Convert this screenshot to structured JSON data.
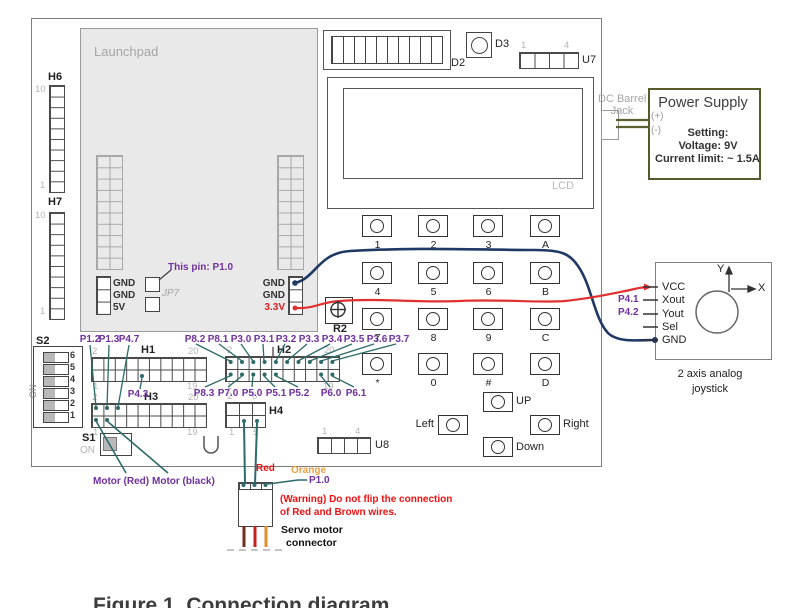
{
  "launchpad": {
    "label": "Launchpad",
    "this_pin": "This pin: P1.0",
    "jp7": "JP7",
    "left_pins": [
      "GND",
      "GND",
      "5V"
    ],
    "right_pins": [
      "GND",
      "GND",
      "3.3V"
    ]
  },
  "headers": {
    "h6": {
      "label": "H6",
      "top": "10",
      "bottom": "1"
    },
    "h7": {
      "label": "H7",
      "top": "10",
      "bottom": "1"
    },
    "h1": {
      "label": "H1",
      "tl": "2",
      "tr": "20",
      "bl": "1",
      "br": "19"
    },
    "h2": {
      "label": "H2",
      "tl": "2",
      "tr": "20",
      "bl": "1",
      "br": "19"
    },
    "h3": {
      "label": "H3",
      "tl": "2",
      "tr": "20",
      "bl": "1",
      "br": "19"
    },
    "h4": {
      "label": "H4",
      "tl": "2",
      "tr": "6",
      "bl": "1",
      "br": "5"
    },
    "u7": {
      "label": "U7",
      "first": "1",
      "last": "4"
    },
    "u8": {
      "label": "U8",
      "first": "1",
      "last": "4"
    }
  },
  "components": {
    "d2": "D2",
    "d3": "D3",
    "r2": "R2",
    "lcd": "LCD"
  },
  "switches": {
    "s2": {
      "label": "S2",
      "on": "ON",
      "numbers": [
        "6",
        "5",
        "4",
        "3",
        "2",
        "1"
      ]
    },
    "s1": {
      "label": "S1",
      "on": "ON"
    }
  },
  "pin_labels": {
    "p12": "P1.2",
    "p13": "P1.3",
    "p47": "P4.7",
    "p43": "P4.3",
    "h2_top": [
      "P8.2",
      "P8.1",
      "P3.0",
      "P3.1",
      "P3.2",
      "P3.3",
      "P3.4",
      "P3.5",
      "P3.6",
      "P3.7"
    ],
    "h2_bottom": [
      "P8.3",
      "P7.0",
      "P5.0",
      "P5.1",
      "P5.2",
      "P6.0",
      "P6.1"
    ]
  },
  "keypad": {
    "rows": [
      [
        "1",
        "2",
        "3",
        "A"
      ],
      [
        "4",
        "5",
        "6",
        "B"
      ],
      [
        "7",
        "8",
        "9",
        "C"
      ],
      [
        "*",
        "0",
        "#",
        "D"
      ]
    ],
    "up": "UP",
    "down": "Down",
    "left": "Left",
    "right": "Right"
  },
  "power_supply": {
    "title": "Power Supply",
    "jack_line1": "DC Barrel",
    "jack_line2": "Jack",
    "plus": "(+)",
    "minus": "(-)",
    "setting": "Setting:",
    "voltage": "Voltage: 9V",
    "current": "Current limit: ~ 1.5A"
  },
  "joystick": {
    "pins": [
      "VCC",
      "Xout",
      "Yout",
      "Sel",
      "GND"
    ],
    "p41": "P4.1",
    "p42": "P4.2",
    "axis_x": "X",
    "axis_y": "Y",
    "caption_line1": "2 axis analog",
    "caption_line2": "joystick"
  },
  "servo": {
    "wire_red": "Red",
    "wire_orange": "Orange",
    "p10": "P1.0",
    "warning_line1": "(Warning) Do not flip the connection",
    "warning_line2": "of Red and Brown wires.",
    "caption_line1": "Servo motor",
    "caption_line2": "connector",
    "motor_red": "Motor (Red)",
    "motor_black": "Motor (black)"
  },
  "figure_caption": "Figure 1. Connection diagram",
  "colors": {
    "purple": "#7030a0",
    "teal": "#2d6a6a",
    "navy": "#1f3864",
    "red_wire": "#e03030",
    "red_text": "#ff0000",
    "olive": "#5c6030",
    "orange": "#f0a040",
    "board_border": "#7f7f7f",
    "launchpad_fill": "#e9e9e9"
  }
}
